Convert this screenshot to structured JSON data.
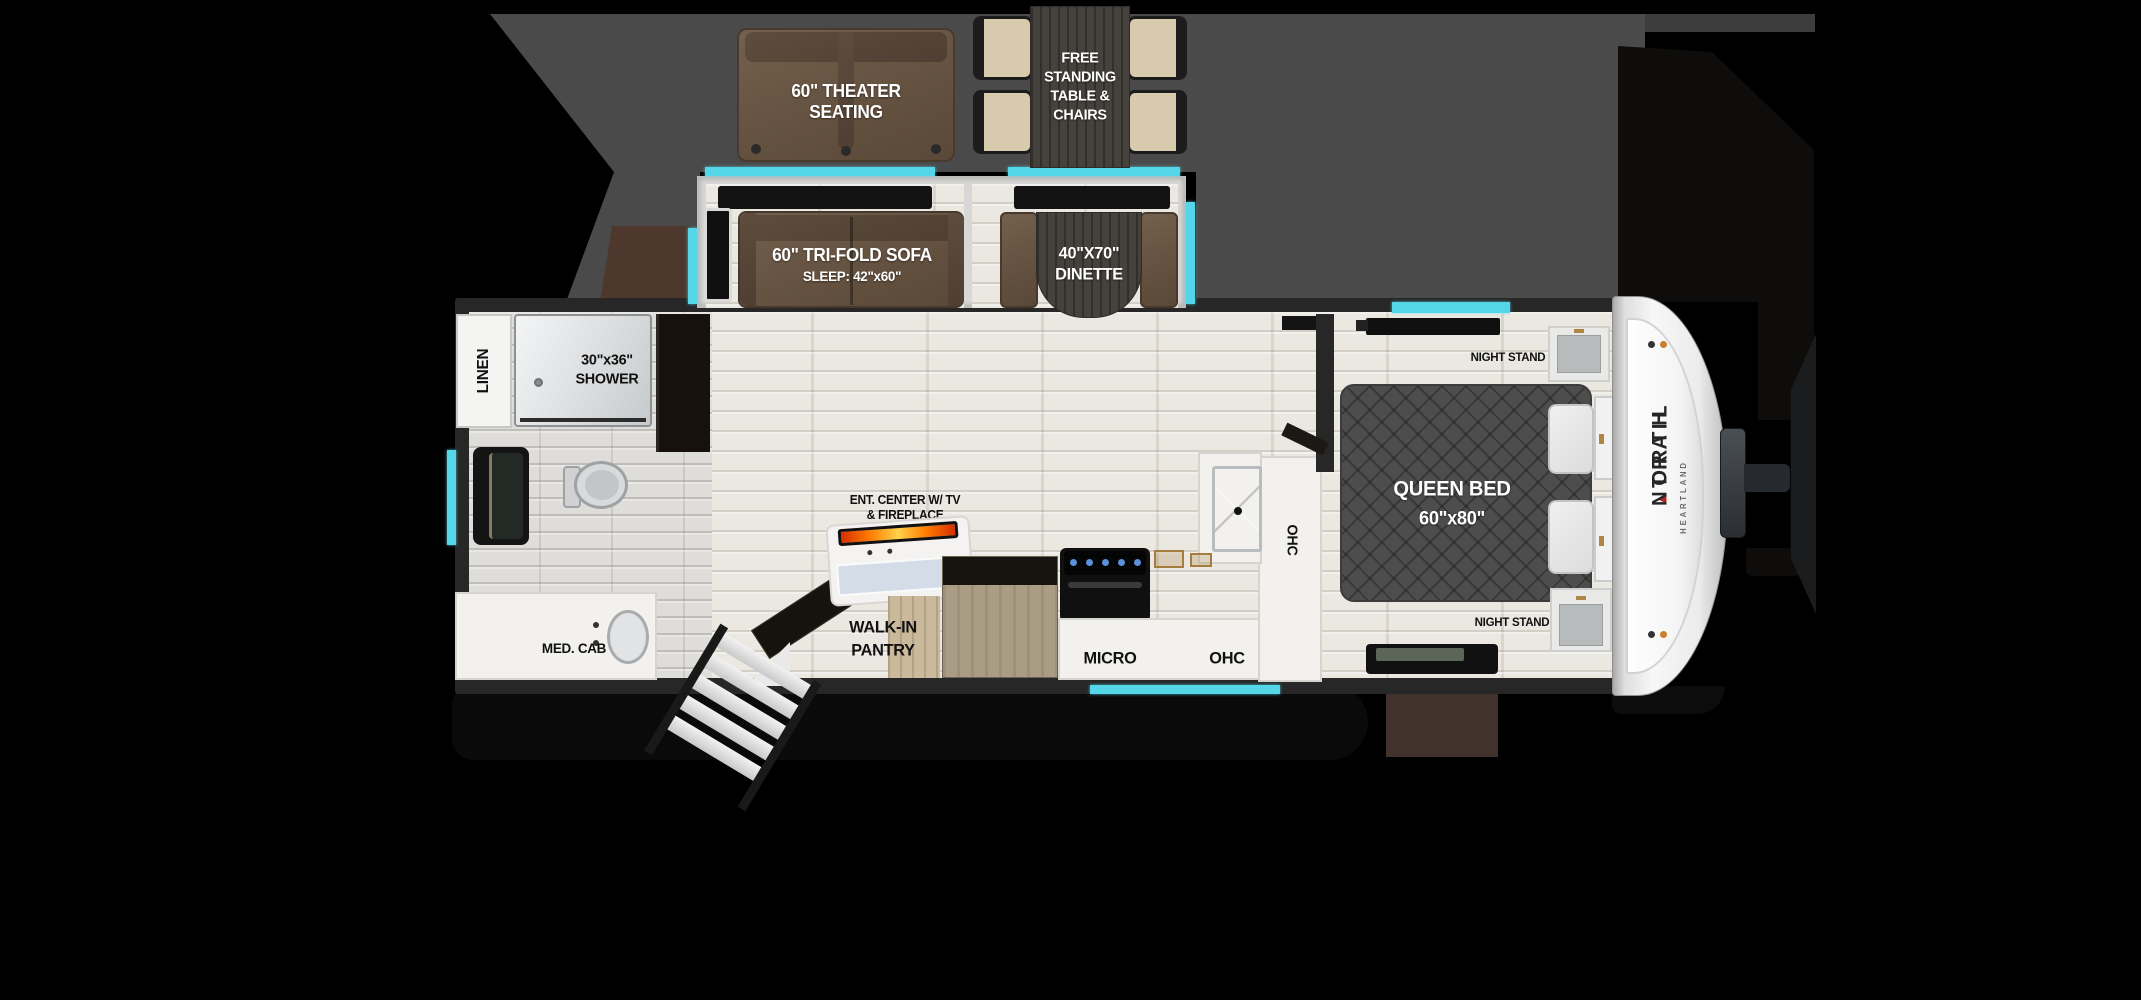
{
  "title": "North Trail travel trailer floor plan",
  "accent_color": "#55d6e8",
  "furniture_labels": {
    "theater_seating": {
      "line1": "60\" THEATER",
      "line2": "SEATING"
    },
    "free_standing_table": {
      "line1": "FREE",
      "line2": "STANDING",
      "line3": "TABLE &",
      "line4": "CHAIRS"
    },
    "tri_fold_sofa": {
      "line1": "60\" TRI-FOLD SOFA",
      "line2": "SLEEP: 42\"x60\""
    },
    "dinette": {
      "line1": "40\"X70\"",
      "line2": "DINETTE"
    },
    "linen": "LINEN",
    "shower": {
      "line1": "30\"x36\"",
      "line2": "SHOWER"
    },
    "med_cab": "MED. CAB",
    "ent_center": {
      "line1": "ENT. CENTER W/ TV",
      "line2": "& FIREPLACE"
    },
    "walk_in_pantry": {
      "line1": "WALK-IN",
      "line2": "PANTRY"
    },
    "micro": "MICRO",
    "ohc_base": "OHC",
    "ohc_side": "OHC",
    "queen_bed": {
      "line1": "QUEEN BED",
      "line2": "60\"x80\""
    },
    "night_stand_front": "NIGHT STAND",
    "night_stand_rear": "NIGHT STAND"
  },
  "branding": {
    "make_word1": "NORTH",
    "make_divider": "▲",
    "make_word2": "TRAIL",
    "manufacturer": "HEARTLAND"
  }
}
